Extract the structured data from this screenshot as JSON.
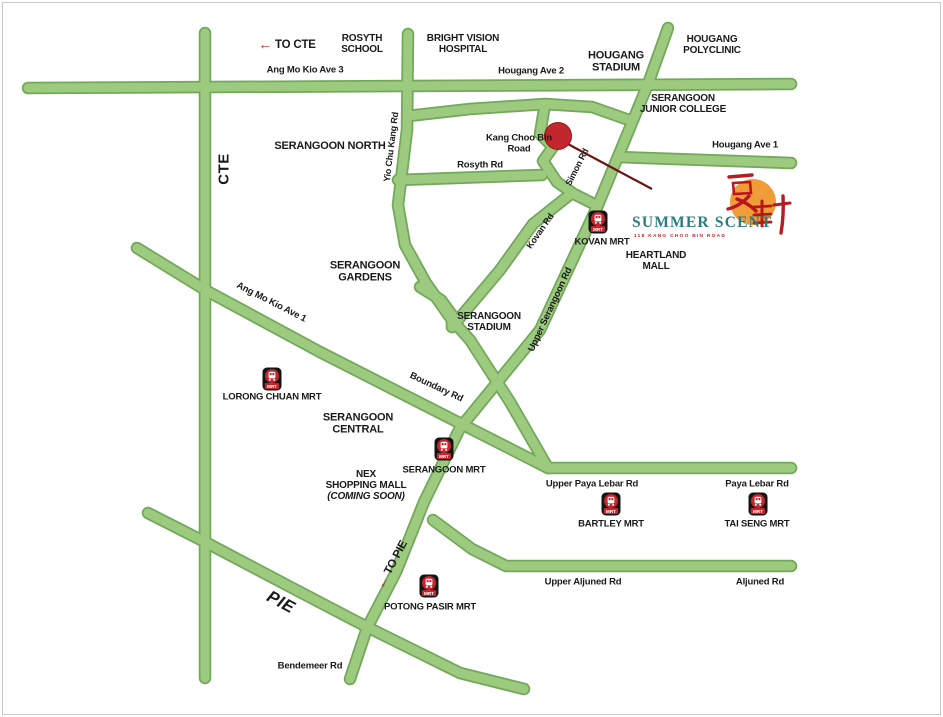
{
  "site": {
    "name": "SUMMER SCENT",
    "tagline": "118 KANG CHOO BIN ROAD",
    "chinese_characters": "夏軒",
    "landmark_note": "site marked by red dot on Kang Choo Bin Road"
  },
  "directions": [
    {
      "id": "to-cte",
      "label": "TO CTE",
      "arrow": "←"
    },
    {
      "id": "to-pie",
      "label": "TO PIE",
      "arrow": "←"
    }
  ],
  "expressways": [
    {
      "id": "cte",
      "label": "CTE"
    },
    {
      "id": "pie",
      "label": "PIE"
    }
  ],
  "roads": [
    {
      "id": "amk-ave-3",
      "label": "Ang Mo Kio Ave 3"
    },
    {
      "id": "hougang-ave-2",
      "label": "Hougang Ave 2"
    },
    {
      "id": "hougang-ave-1",
      "label": "Hougang Ave 1"
    },
    {
      "id": "yio-chu-kang-rd",
      "label": "Yio Chu Kang Rd"
    },
    {
      "id": "rosyth-rd",
      "label": "Rosyth Rd"
    },
    {
      "id": "simon-rd",
      "label": "Simon Rd"
    },
    {
      "id": "kovan-rd",
      "label": "Kovan Rd"
    },
    {
      "id": "upper-serangoon-rd",
      "label": "Upper Serangoon Rd"
    },
    {
      "id": "amk-ave-1",
      "label": "Ang Mo Kio Ave 1"
    },
    {
      "id": "boundary-rd",
      "label": "Boundary Rd"
    },
    {
      "id": "upper-paya-lebar-rd",
      "label": "Upper Paya Lebar Rd"
    },
    {
      "id": "paya-lebar-rd",
      "label": "Paya Lebar Rd"
    },
    {
      "id": "upper-aljuned-rd",
      "label": "Upper Aljuned Rd"
    },
    {
      "id": "aljuned-rd",
      "label": "Aljuned Rd"
    },
    {
      "id": "bendemeer-rd",
      "label": "Bendemeer Rd"
    }
  ],
  "places": [
    {
      "id": "rosyth-school",
      "lines": [
        "ROSYTH",
        "SCHOOL"
      ]
    },
    {
      "id": "bright-vision-hospital",
      "lines": [
        "BRIGHT VISION",
        "HOSPITAL"
      ]
    },
    {
      "id": "hougang-stadium",
      "lines": [
        "HOUGANG",
        "STADIUM"
      ]
    },
    {
      "id": "hougang-polyclinic",
      "lines": [
        "HOUGANG",
        "POLYCLINIC"
      ]
    },
    {
      "id": "serangoon-junior-college",
      "lines": [
        "SERANGOON",
        "JUNIOR COLLEGE"
      ]
    },
    {
      "id": "kang-choo-bin-road",
      "lines": [
        "Kang Choo Bin",
        "Road"
      ]
    },
    {
      "id": "serangoon-north",
      "lines": [
        "SERANGOON NORTH"
      ]
    },
    {
      "id": "serangoon-gardens",
      "lines": [
        "SERANGOON",
        "GARDENS"
      ]
    },
    {
      "id": "serangoon-stadium",
      "lines": [
        "SERANGOON",
        "STADIUM"
      ]
    },
    {
      "id": "heartland-mall",
      "lines": [
        "HEARTLAND",
        "MALL"
      ]
    },
    {
      "id": "serangoon-central",
      "lines": [
        "SERANGOON",
        "CENTRAL"
      ]
    },
    {
      "id": "nex-shopping-mall",
      "lines": [
        "NEX",
        "SHOPPING MALL",
        "(COMING SOON)"
      ]
    }
  ],
  "mrt_stations": [
    {
      "id": "kovan-mrt",
      "label": "KOVAN MRT"
    },
    {
      "id": "lorong-chuan-mrt",
      "label": "LORONG CHUAN MRT"
    },
    {
      "id": "serangoon-mrt",
      "label": "SERANGOON MRT"
    },
    {
      "id": "bartley-mrt",
      "label": "BARTLEY MRT"
    },
    {
      "id": "tai-seng-mrt",
      "label": "TAI SENG MRT"
    },
    {
      "id": "potong-pasir-mrt",
      "label": "POTONG PASIR MRT"
    }
  ],
  "mrt_icon_text": "MRT",
  "colors": {
    "road_fill": "#9ccb80",
    "road_border": "#72a85a",
    "mrt_red": "#c1272d",
    "site_dot": "#c1272d",
    "pointer_line": "#6e1414",
    "logo_orange": "#f09c38",
    "logo_teal": "#2c7b7e",
    "logo_red": "#b5121b",
    "arrow_red": "#c1272d",
    "label_black": "#1a1a1a"
  }
}
